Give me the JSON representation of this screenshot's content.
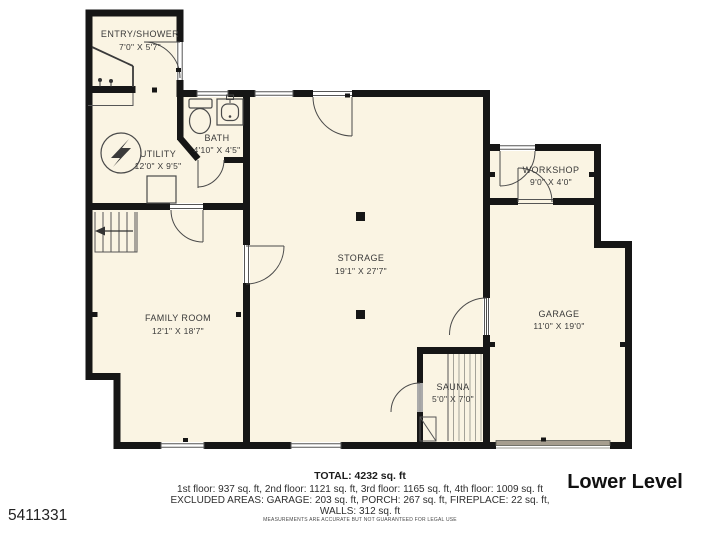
{
  "plan": {
    "level_label": "Lower Level",
    "listing_id": "5411331",
    "disclaimer": "MEASUREMENTS ARE ACCURATE BUT NOT GUARANTEED FOR LEGAL USE",
    "summary": {
      "total": "TOTAL: 4232 sq. ft",
      "floors": "1st floor: 937 sq. ft, 2nd floor: 1121 sq. ft, 3rd floor: 1165 sq. ft, 4th floor: 1009 sq. ft",
      "excluded": "EXCLUDED AREAS: GARAGE: 203 sq. ft, PORCH: 267 sq. ft, FIREPLACE: 22 sq. ft,",
      "walls": "WALLS: 312 sq. ft"
    },
    "rooms": {
      "entry_shower": {
        "name": "ENTRY/SHOWER",
        "dims": "7'0\" X 5'7\""
      },
      "utility": {
        "name": "UTILITY",
        "dims": "12'0\" X 9'5\""
      },
      "bath": {
        "name": "BATH",
        "dims": "4'10\" X 4'5\""
      },
      "storage": {
        "name": "STORAGE",
        "dims": "19'1\" X 27'7\""
      },
      "family_room": {
        "name": "FAMILY ROOM",
        "dims": "12'1\" X 18'7\""
      },
      "workshop": {
        "name": "WORKSHOP",
        "dims": "9'0\" X 4'0\""
      },
      "garage": {
        "name": "GARAGE",
        "dims": "11'0\" X 19'0\""
      },
      "sauna": {
        "name": "SAUNA",
        "dims": "5'0\" X 7'0\""
      }
    },
    "colors": {
      "floor": "#faf4e3",
      "wall": "#161616",
      "garage_door": "#a69e8f"
    }
  }
}
